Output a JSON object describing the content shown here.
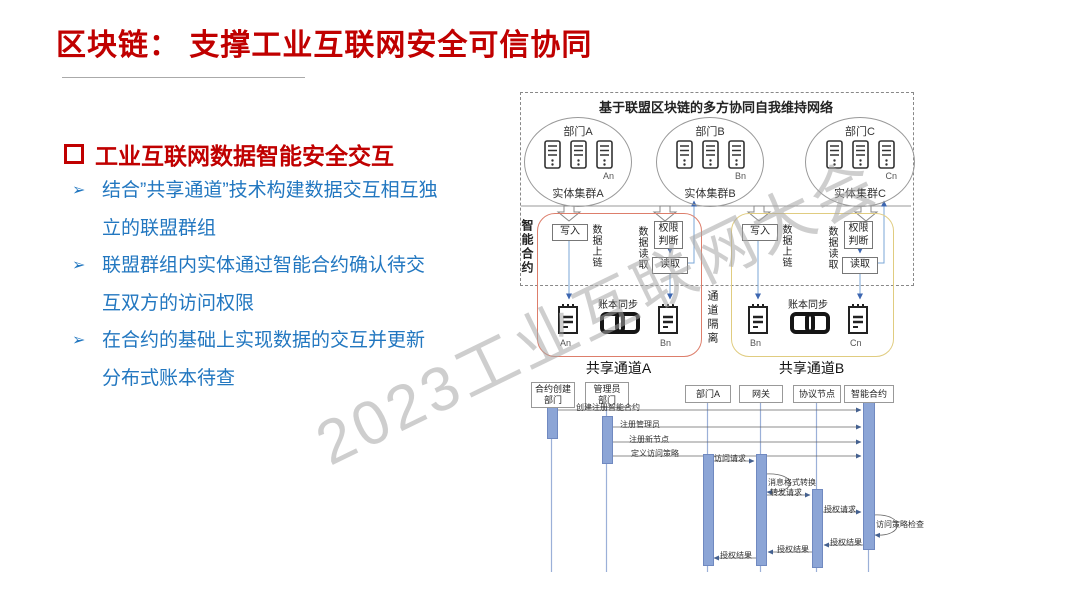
{
  "slide": {
    "title": "区块链： 支撑工业互联网安全可信协同",
    "watermark": "2023工业互联网大会"
  },
  "colors": {
    "title_red": "#C00000",
    "bullet_blue": "#2277C0",
    "channel_a_border": "#DD7E6B",
    "channel_b_border": "#E0CC80",
    "activation_fill": "#8CA5D6",
    "connector_blue": "#7BA7D7"
  },
  "icons": {
    "bullet_marker": "➢",
    "heading_marker": "hollow-square-icon",
    "server": "server-icon",
    "ledger": "ledger-icon",
    "chain": "chain-link-icon"
  },
  "left_panel": {
    "heading": "工业互联网数据智能安全交互",
    "bullets": [
      "结合”共享通道”技术构建数据交互相互独立的联盟群组",
      "联盟群组内实体通过智能合约确认待交互双方的访问权限",
      "在合约的基础上实现数据的交互并更新分布式账本待查"
    ]
  },
  "diagram": {
    "title": "基于联盟区块链的多方协同自我维持网络",
    "smart_contract_label": "智能合约",
    "isolation_label": "通道隔离",
    "clusters": [
      {
        "dept": "部门A",
        "node": "An",
        "cluster": "实体集群A"
      },
      {
        "dept": "部门B",
        "node": "Bn",
        "cluster": "实体集群B"
      },
      {
        "dept": "部门C",
        "node": "Cn",
        "cluster": "实体集群C"
      }
    ],
    "channels": [
      {
        "name": "共享通道A",
        "write_label": "写入",
        "upchain_label": "数据上链",
        "readdata_label": "数据读取",
        "perm_label": "权限判断",
        "read_label": "读取",
        "sync_label": "账本同步",
        "ledger_left": "An",
        "ledger_right": "Bn"
      },
      {
        "name": "共享通道B",
        "write_label": "写入",
        "upchain_label": "数据上链",
        "readdata_label": "数据读取",
        "perm_label": "权限判断",
        "read_label": "读取",
        "sync_label": "账本同步",
        "ledger_left": "Bn",
        "ledger_right": "Cn"
      }
    ]
  },
  "sequence": {
    "actors": [
      {
        "line1": "合约创建",
        "line2": "部门"
      },
      {
        "line1": "管理员",
        "line2": "部门"
      },
      {
        "line1": "部门A",
        "line2": ""
      },
      {
        "line1": "网关",
        "line2": ""
      },
      {
        "line1": "协议节点",
        "line2": ""
      },
      {
        "line1": "智能合约",
        "line2": ""
      }
    ],
    "messages": [
      "创建注册智能合约",
      "注册管理员",
      "注册新节点",
      "定义访问策略",
      "访问请求",
      "消息格式转换",
      "转发请求",
      "授权请求",
      "访问策略检查",
      "授权结果",
      "授权结果",
      "授权结果"
    ]
  }
}
